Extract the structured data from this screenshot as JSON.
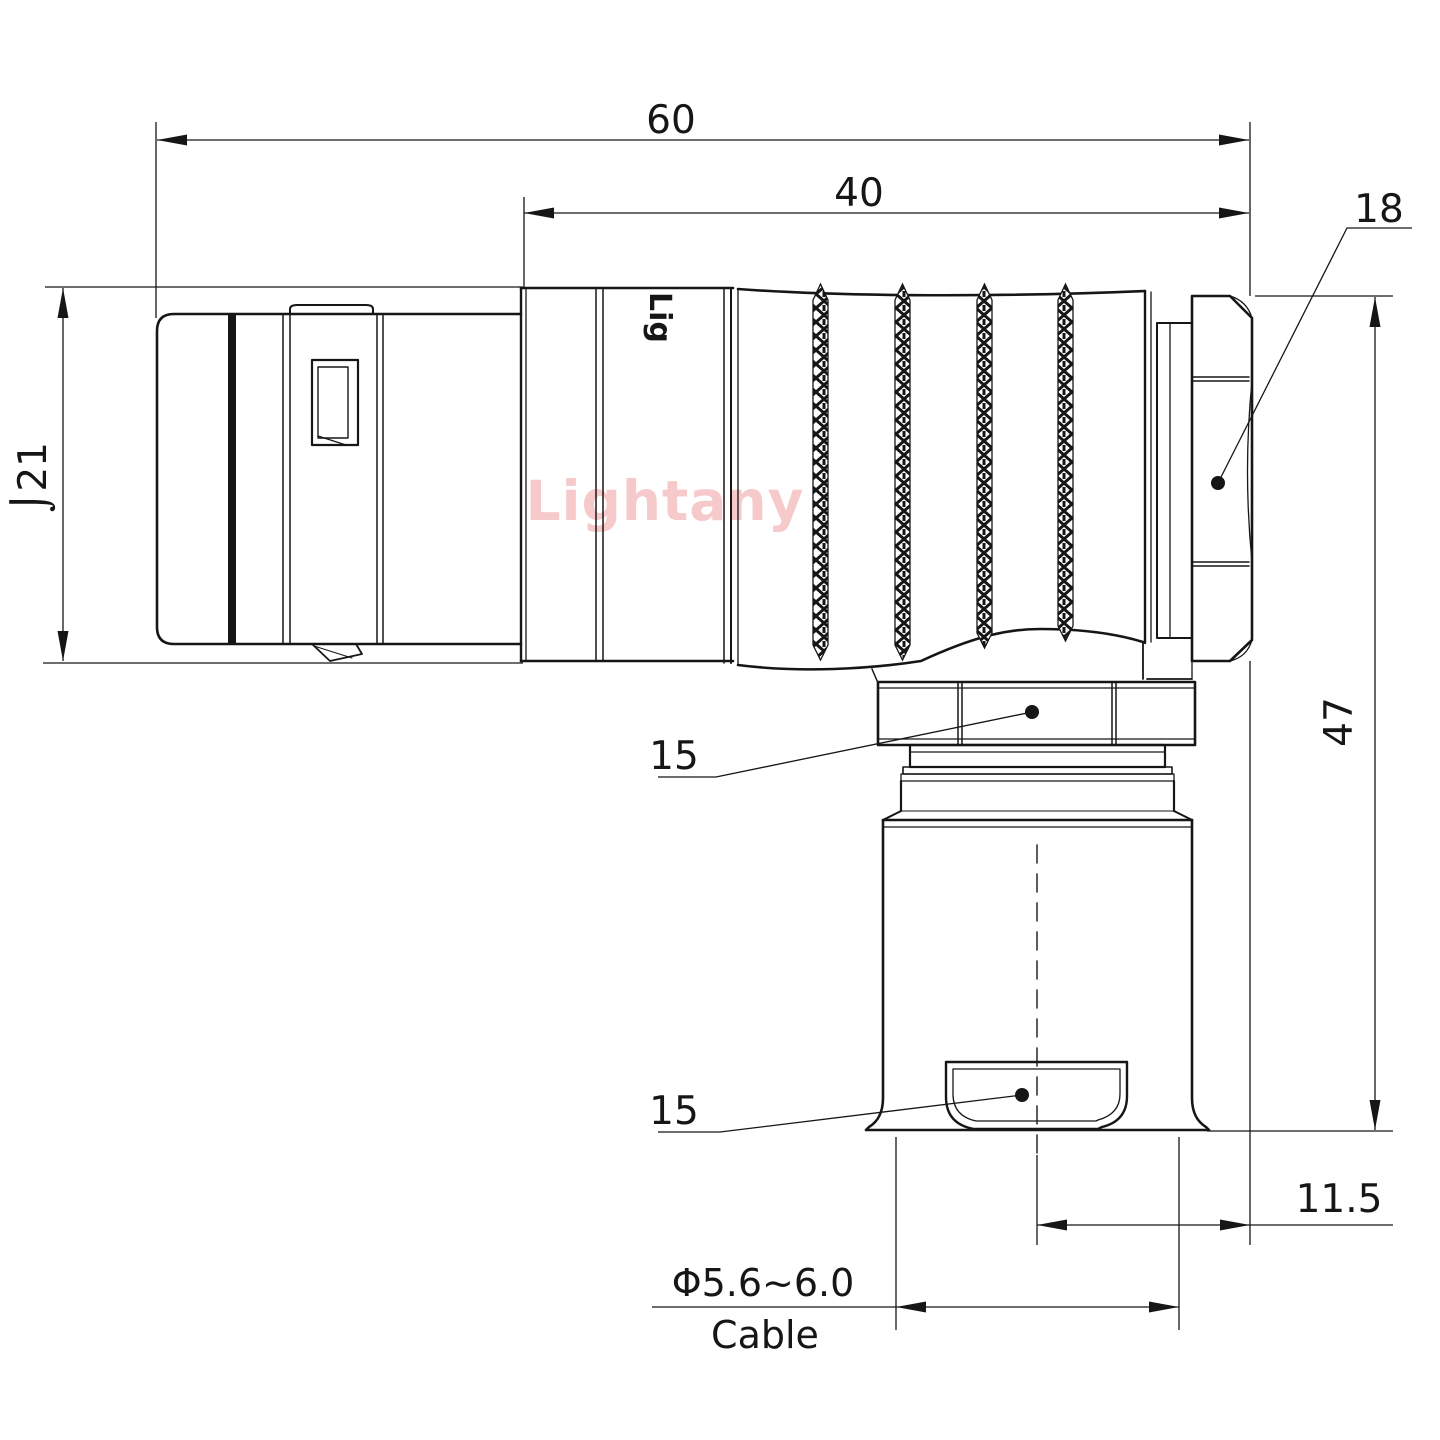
{
  "drawing": {
    "watermark": {
      "text": "Lightany",
      "color": "#f6caca"
    },
    "shell_logo": "Lig",
    "dimensions": {
      "overall_length": "60",
      "shell_length": "40",
      "nut_across_flats": "18",
      "shell_diameter": "⌡21",
      "overall_height": "47",
      "coupling_hex_upper": "15",
      "coupling_hex_lower": "15",
      "axis_offset": "11.5",
      "cable_diameter_range": "Φ5.6~6.0",
      "cable_caption": "Cable"
    },
    "colors": {
      "line": "#161616",
      "background": "#ffffff"
    }
  }
}
